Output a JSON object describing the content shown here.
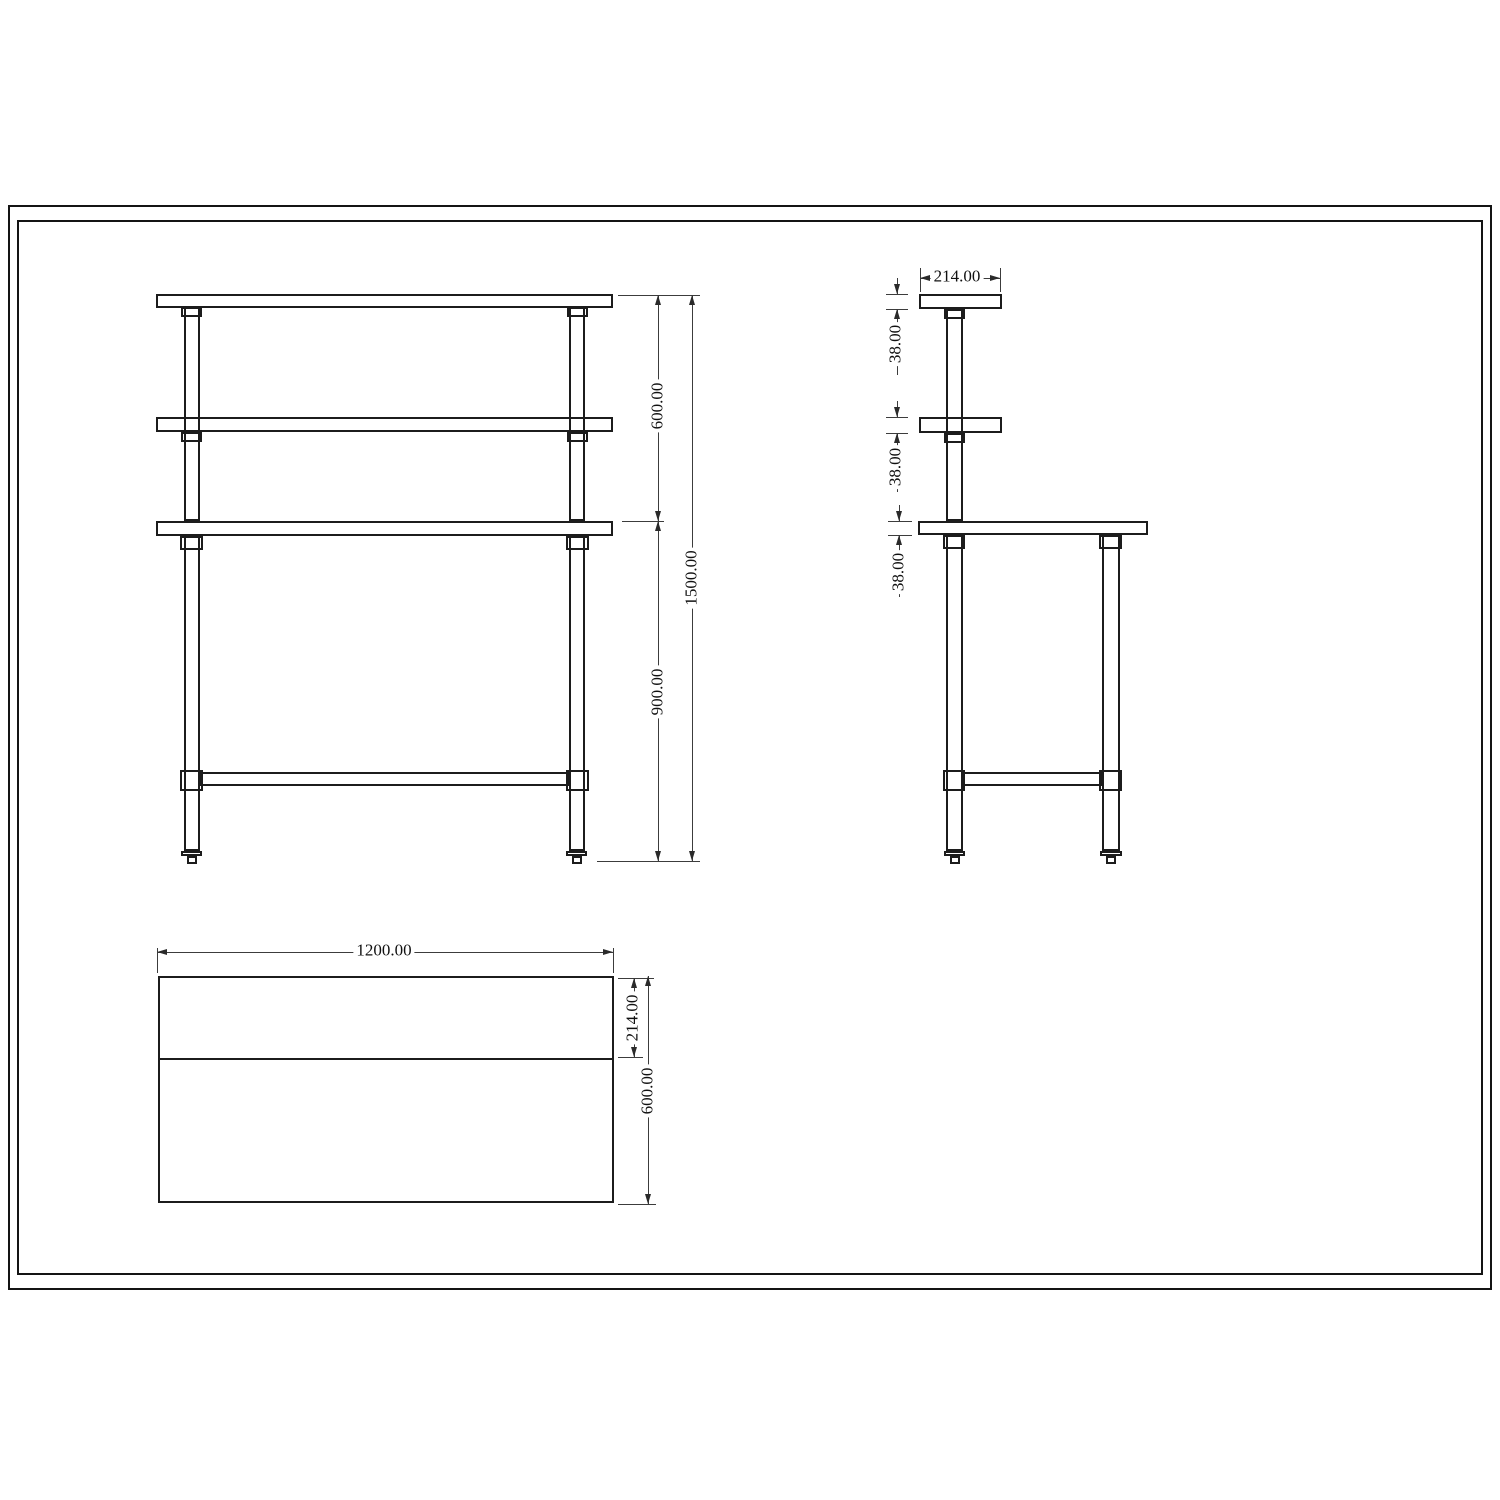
{
  "dimensions": {
    "front": {
      "upper_height": "600.00",
      "total_height": "1500.00",
      "working_height": "900.00"
    },
    "side": {
      "shelf_depth": "214.00",
      "top_shelf_thickness": "38.00",
      "mid_shelf_thickness": "38.00",
      "worktop_thickness": "38.00"
    },
    "plan": {
      "length": "1200.00",
      "overshelf_depth": "214.00",
      "table_depth": "600.00"
    }
  }
}
